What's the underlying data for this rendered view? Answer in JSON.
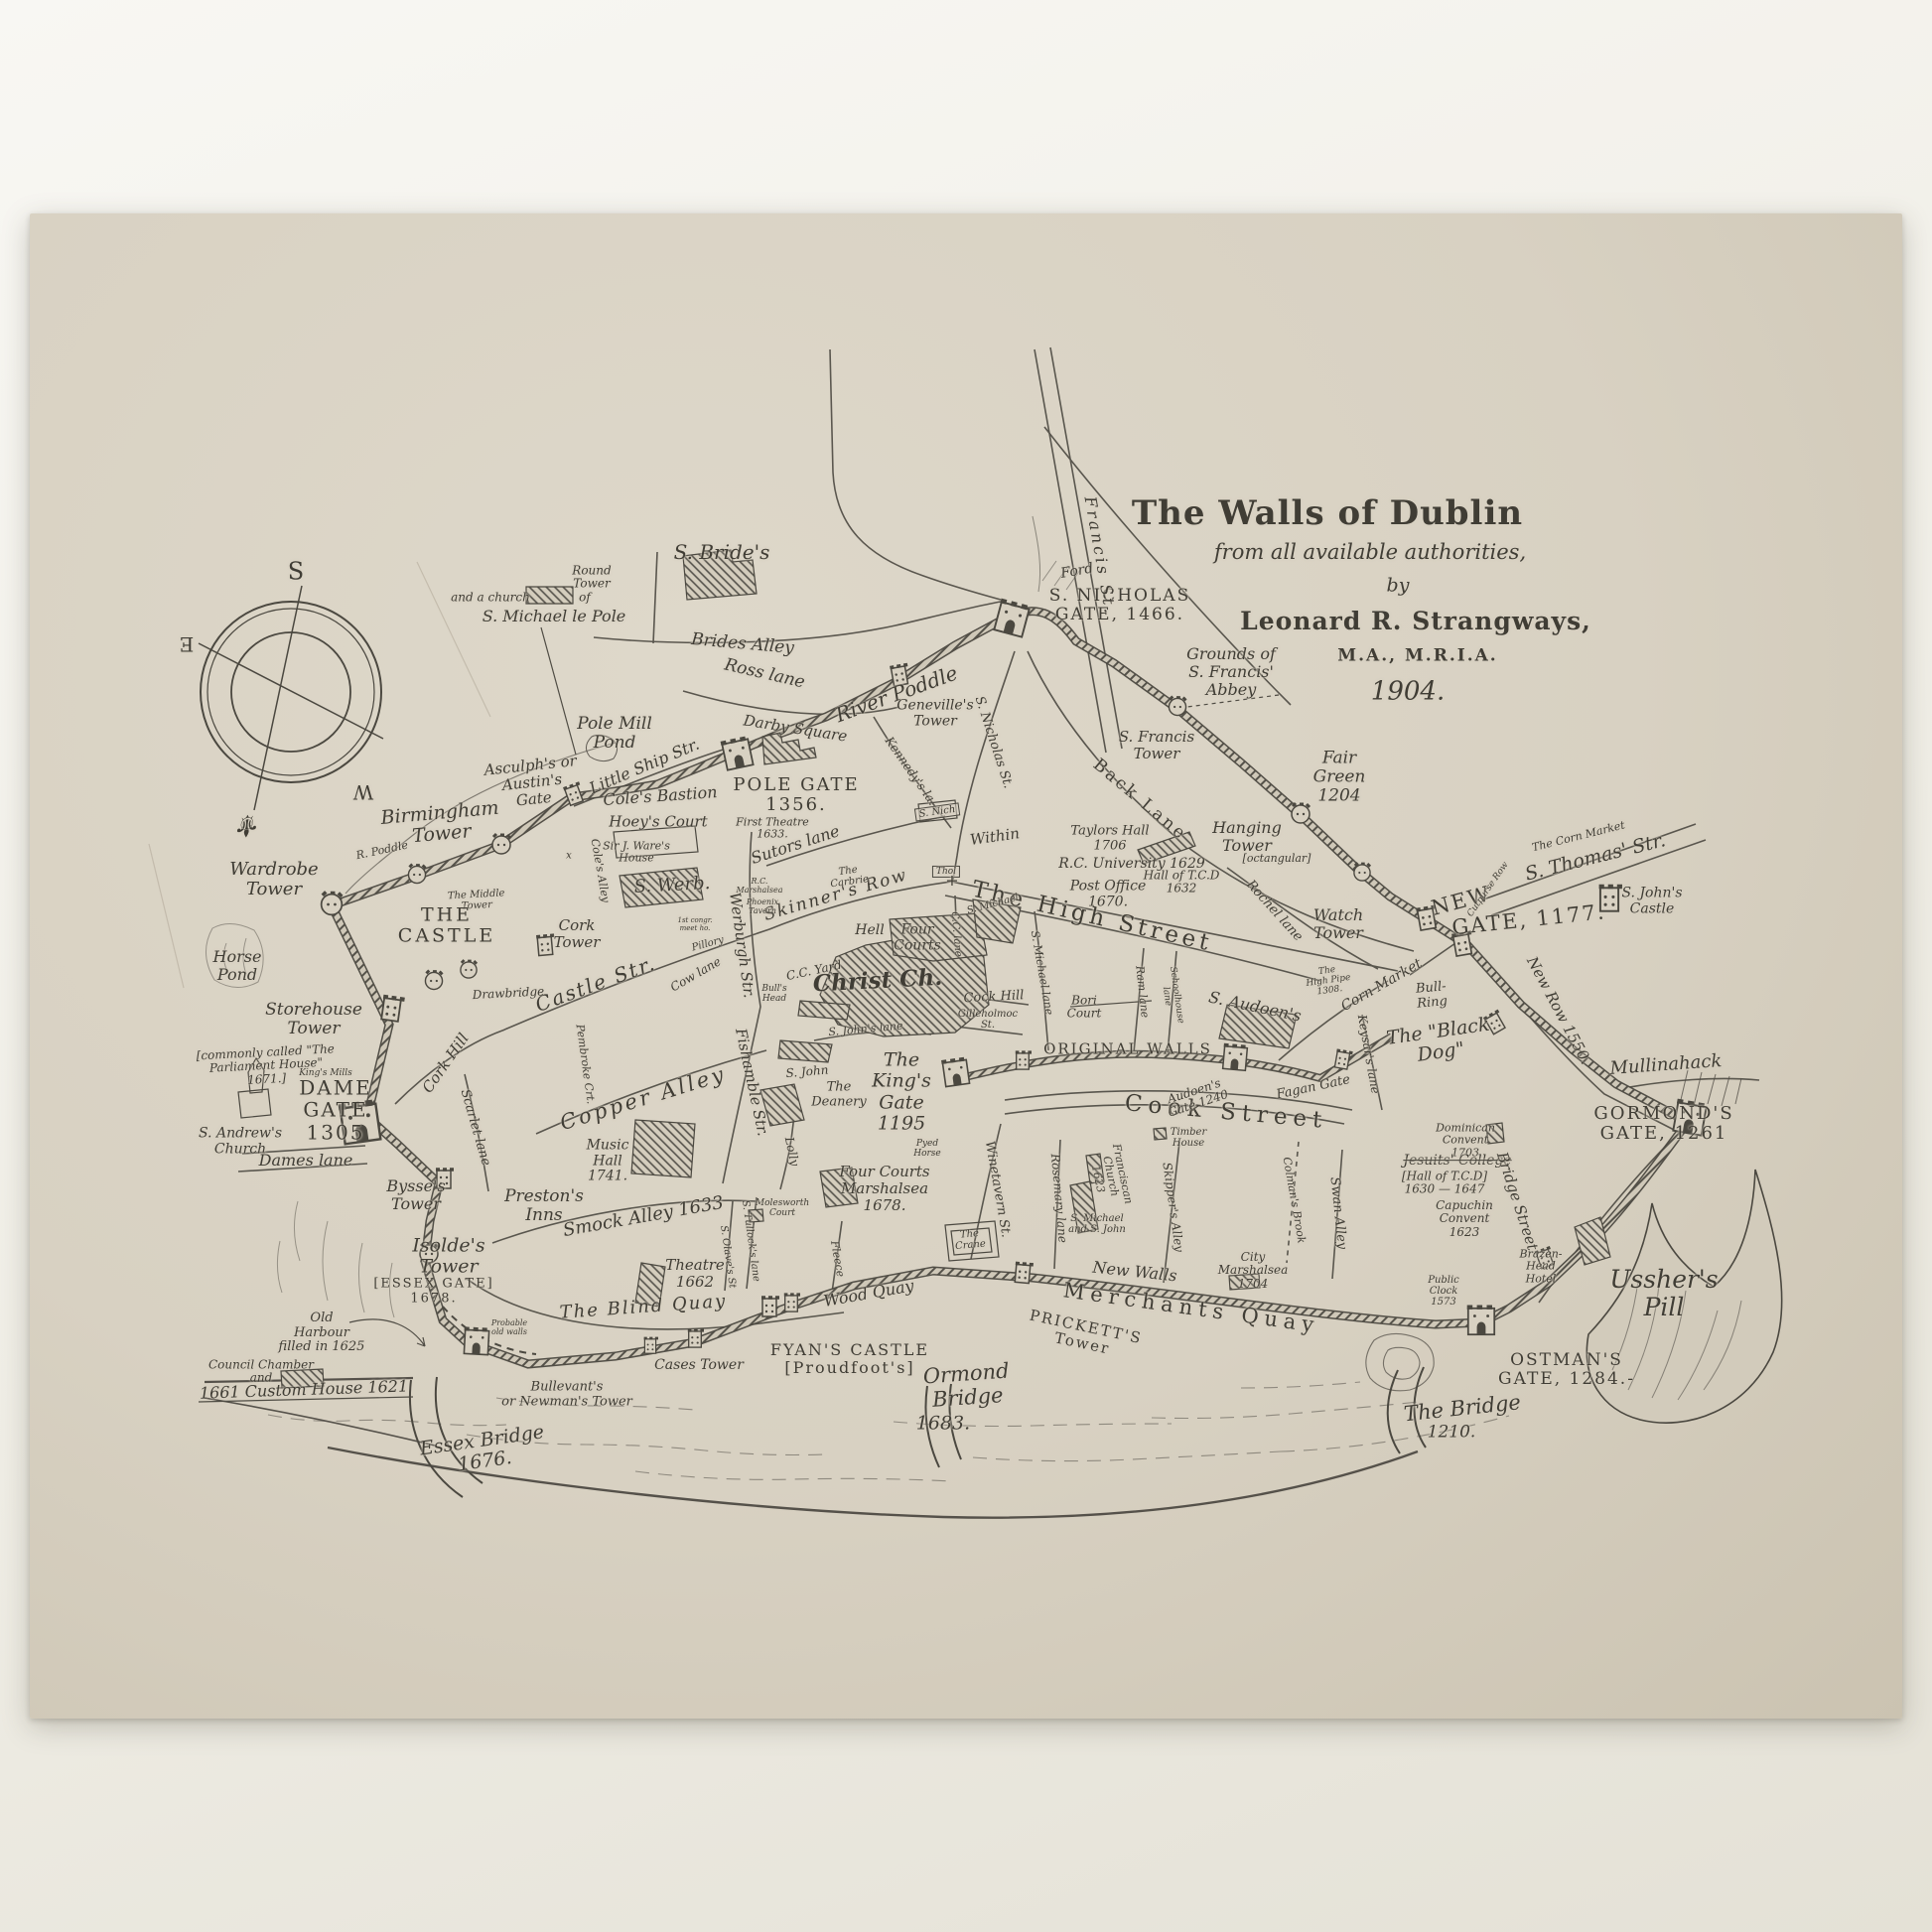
{
  "colors": {
    "paper": "#d8d1c2",
    "ink": "#4b4840",
    "background": "#efede5"
  },
  "title": {
    "main": "The Walls of Dublin",
    "sub": "from all available authorities,",
    "by": "by",
    "author": "Leonard R. Strangways,",
    "degrees": "M.A., M.R.I.A.",
    "year": "1904."
  },
  "compass": {
    "s": "S",
    "e": "E",
    "w": "W",
    "fleur": "⚜"
  },
  "labels": {
    "s_brides": "S. Bride's",
    "brides_alley": "Brides Alley",
    "ross_lane": "Ross lane",
    "darby_square": "Darby Square",
    "river_poddle": "River Poddle",
    "round_tower": "Round\nTower",
    "and_a_church": "and a church",
    "of_word": "of",
    "michael_le_pole": "S. Michael le Pole",
    "pole_mill_pond": "Pole Mill\nPond",
    "little_ship_str": "Little Ship Str.",
    "asculphs_gate": "Asculph's or\nAustin's\nGate",
    "coles_bastion": "Cole's Bastion",
    "pole_gate": "POLE GATE\n1356.",
    "hoeys_court": "Hoey's Court",
    "sir_wares_house": "Sir J. Ware's\nHouse",
    "first_theatre": "First Theatre\n1633.",
    "sutors_lane": "Sutors lane",
    "s_werb": "S. Werb.",
    "kennedys_la": "Kennedy's la.",
    "s_nicholas_st": "S. Nicholas St.",
    "s_nich": "S. Nich",
    "within": "Within",
    "thol": "Thol",
    "ford": "Ford",
    "s_nicholas_gate": "S. NICHOLAS\nGATE, 1466.",
    "grounds_abbey": "Grounds of\nS. Francis'\nAbbey",
    "francis_st": "Francis St.",
    "s_francis_tower": "S. Francis\nTower",
    "fair_green": "Fair\nGreen\n1204",
    "back_lane": "Back Lane",
    "rochel_lane": "Rochel lane",
    "taylors_hall": "Taylors Hall\n1706",
    "rc_university": "R.C. University 1629",
    "hall_of_tcd": "Hall of T.C.D\n1632",
    "post_office": "Post Office\n1670.",
    "hanging_tower": "Hanging\nTower",
    "octangular": "[octangular]",
    "watch_tower": "Watch\nTower",
    "new_gate_1": "NEW",
    "new_gate_2": "GATE, 1177.",
    "the_corn_market": "The Corn Market",
    "s_thomas_str": "S. Thomas' Str.",
    "cutpurse_row": "Cutpurse Row",
    "s_johns_castle": "S. John's\nCastle",
    "new_row": "New Row 1550.",
    "mullinahack": "Mullinahack",
    "black_dog": "The \"Black\nDog\"",
    "bull_ring": "Bull-\nRing",
    "high_pipe": "The\nHigh Pipe\n1308.",
    "corn_market": "Corn Market",
    "keysars_lane": "Keysar's lane",
    "gormonds_gate": "GORMOND'S\nGATE, 1261",
    "dominican": "Dominican\nConvent\n1703",
    "jesuits": "Jesuits' College",
    "hall_tcd2": "[Hall of T.C.D]\n1630 — 1647",
    "capuchin": "Capuchin\nConvent\n1623",
    "bridge_street": "Bridge Street",
    "brazen_head": "Brazen-\nHead\nHotel",
    "public_clock": "Public\nClock\n1573",
    "ushers_pill": "Ussher's\nPill",
    "ostmans_gate": "OSTMAN'S\nGATE, 1284.-",
    "the_bridge": "The Bridge",
    "bridge_1210": "1210.",
    "original_walls": "ORIGINAL WALLS",
    "cook_street": "Cook Street",
    "audoens_gate": "Audoen's\nGate 1240",
    "fagan_gate": "Fagan Gate",
    "timber_house": "Timber\nHouse",
    "rosemary_lane": "Rosemary lane",
    "franciscan_church": "Franciscan\nChurch\n1623",
    "s_michael_john": "S. Michael\nand S. John",
    "skippers_alley": "Skipper's Alley",
    "colmans_brook": "Colman's Brook",
    "swan_alley": "Swan Alley",
    "city_marshalsea": "City\nMarshalsea\n1704",
    "new_walls": "New Walls",
    "merchants_quay": "Merchants Quay",
    "pricketts_tower": "PRICKETT'S\nTower",
    "ormond_bridge": "Ormond\nBridge",
    "ormond_1683": "1683.",
    "fyans_castle": "FYAN'S CASTLE\n[Proudfoot's]",
    "cases_tower": "Cases Tower",
    "wood_quay": "Wood Quay",
    "blind_quay": "The Blind Quay",
    "bullevants": "Bullevant's\nor Newman's Tower",
    "essex_bridge": "Essex Bridge\n1676.",
    "old_harbour": "Old\nHarbour\nfilled in 1625",
    "council_chamber": "Council Chamber\nand",
    "custom_house": "1661 Custom House 1621",
    "probable_walls": "Probable\nold walls",
    "isoldes_tower": "Isolde's\nTower",
    "essex_gate": "[ESSEX GATE]\n1678.",
    "bysses_tower": "Bysse's\nTower",
    "dame_gate": "DAME\nGATE\n1305",
    "parliament": "[commonly called \"The\nParliament House\"\n1671.]",
    "kings_mills": "King's Mills",
    "s_andrews": "S. Andrew's\nChurch",
    "dames_lane": "Dames lane",
    "cork_hill": "Cork Hill",
    "castle_str": "Castle Str.",
    "scarlet_lane": "Scarlet lane",
    "pembroke_crt": "Pembroke Crt.",
    "coles_alley": "Cole's Alley",
    "werburgh_str": "Werburgh Str.",
    "fishamble_str": "Fishamble Str.",
    "lolly": "Lolly",
    "copper_alley": "Copper Alley",
    "music_hall": "Music\nHall\n1741.",
    "prestons_inns": "Preston's\nInns",
    "smock_alley": "Smock Alley 1633",
    "theatre_1662": "Theatre\n1662",
    "s_olaves_st": "S. Olave's St",
    "s_tullocks_lane": "S. Tullock's lane",
    "molesworth_court": "Molesworth\nCourt",
    "fleece_alley": "Fleece",
    "four_courts_marshalsea": "Four Courts\nMarshalsea\n1678.",
    "kings_gate": "The\nKing's\nGate\n1195",
    "the_deanery": "The\nDeanery",
    "s_john": "S. John",
    "s_johns_lane": "S. John's lane",
    "pyed_horse": "Pyed\nHorse",
    "christ_ch": "Christ Ch.",
    "cc_yard": "C.C. Yard",
    "hell": "Hell",
    "four_courts": "Four\nCourts",
    "skinners_row": "Skinner's Row",
    "bulls_head": "Bull's\nHead",
    "cow_lane": "Cow lane",
    "pillory": "Pillory",
    "rc_marshalsea": "R.C.\nMarshalsea",
    "phoenix_tavern": "Phoenix\nTavern",
    "the_carbrie": "The\nCarbrie",
    "congr_house": "1st congr.\nmeet ho.",
    "high_street": "The High Street",
    "s_michael_lane": "S. Michael lane",
    "s_michael_ch": "S. Michael",
    "cc_lane": "C.C. lane",
    "cock_hill": "Cock Hill",
    "gilleholmoc": "Gilleholmoc\nSt.",
    "bori_court": "Bori\nCourt",
    "ram_lane": "Ram lane",
    "schoolhouse_lane": "Schoolhouse\nlane",
    "s_audoens": "S. Audoen's",
    "winetavern_st": "Winetavern St.",
    "the_crane": "The\nCrane",
    "horse_pond": "Horse\nPond",
    "wardrobe_tower": "Wardrobe\nTower",
    "r_poddle": "R. Poddle",
    "birmingham_tower": "Birmingham\nTower",
    "middle_tower": "The Middle\nTower",
    "the_castle": "THE\nCASTLE",
    "cork_tower": "Cork\nTower",
    "storehouse_tower": "Storehouse\nTower",
    "drawbridge": "Drawbridge",
    "genevilles_tower": "Geneville's\nTower",
    "x_mark": "x",
    "cross_mark": "+"
  }
}
